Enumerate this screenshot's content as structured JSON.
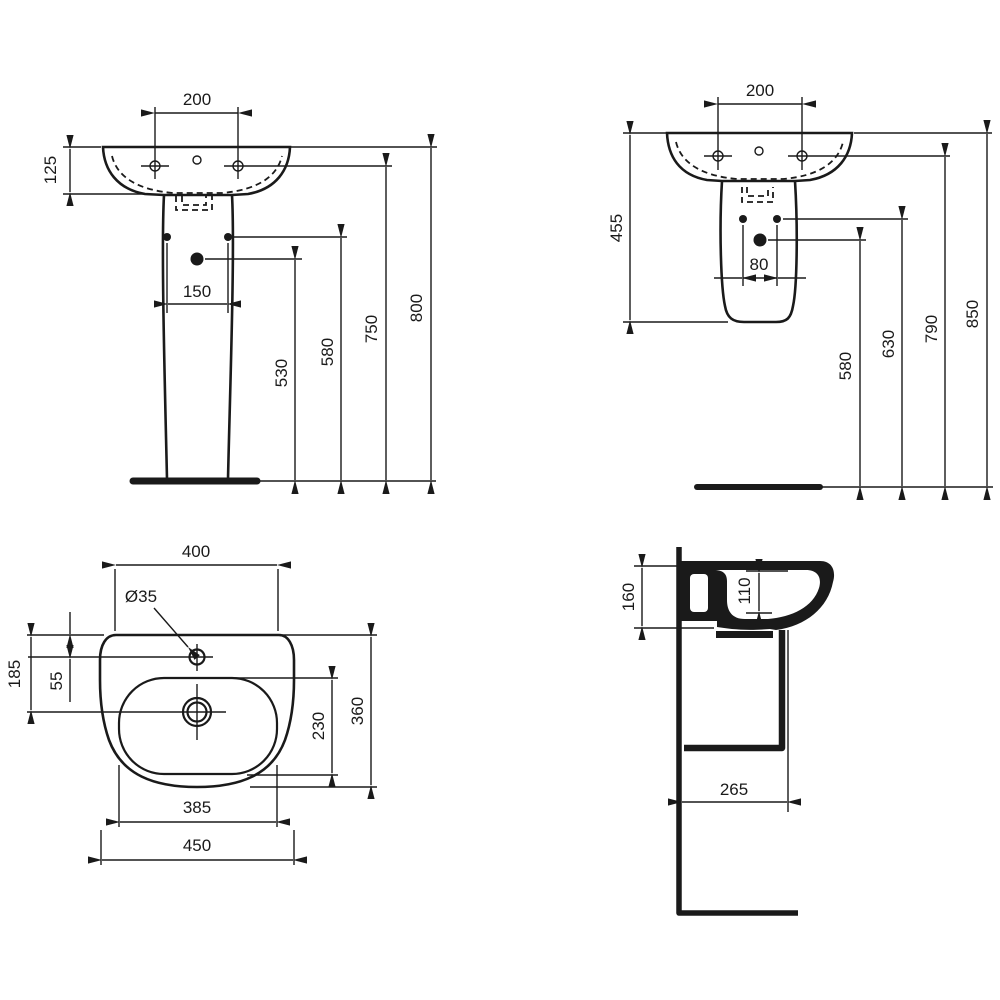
{
  "drawing": {
    "front_pedestal": {
      "tap_centres": "200",
      "rim_to_underside": "125",
      "fixing_centres": "150",
      "trap_height": "530",
      "fixing_height": "580",
      "tap_height": "750",
      "rim_height": "800"
    },
    "front_semi_pedestal": {
      "tap_centres": "200",
      "basin_shroud_height": "455",
      "fixing_centres": "80",
      "trap_height": "580",
      "fixing_height": "630",
      "tap_height": "790",
      "rim_height": "850"
    },
    "plan": {
      "back_width": "400",
      "tap_hole_diameter": "Ø35",
      "rim_to_drain": "185",
      "rim_to_tap": "55",
      "bowl_depth": "230",
      "overall_depth": "360",
      "bowl_width": "385",
      "overall_width": "450"
    },
    "side": {
      "apron_height": "160",
      "bowl_inner_depth": "110",
      "shroud_projection": "265"
    }
  },
  "colors": {
    "ink": "#1a1a1a",
    "paper": "#ffffff"
  }
}
